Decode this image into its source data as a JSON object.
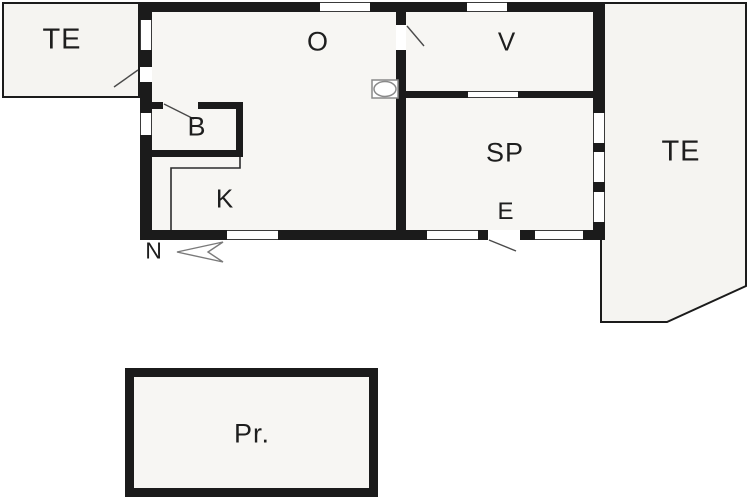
{
  "plan": {
    "type": "floor-plan",
    "rooms": [
      {
        "id": "terrace-left",
        "label": "TE"
      },
      {
        "id": "living-room",
        "label": "O"
      },
      {
        "id": "v-room",
        "label": "V"
      },
      {
        "id": "bathroom",
        "label": "B"
      },
      {
        "id": "sp-room",
        "label": "SP"
      },
      {
        "id": "kitchen",
        "label": "K"
      },
      {
        "id": "entrance",
        "label": "E"
      },
      {
        "id": "terrace-right",
        "label": "TE"
      },
      {
        "id": "outbuilding",
        "label": "Pr."
      }
    ],
    "compass": {
      "label": "N",
      "direction": "arrow-points-left"
    },
    "icons": [
      "stove-icon",
      "north-arrow-icon"
    ],
    "colors": {
      "wall": "#1b1b1b",
      "room_fill": "#f7f6f3",
      "terrace_fill": "#f5f4f1",
      "swing_line": "#4a4a4a",
      "outline_gray": "#888888",
      "background": "#ffffff"
    }
  }
}
